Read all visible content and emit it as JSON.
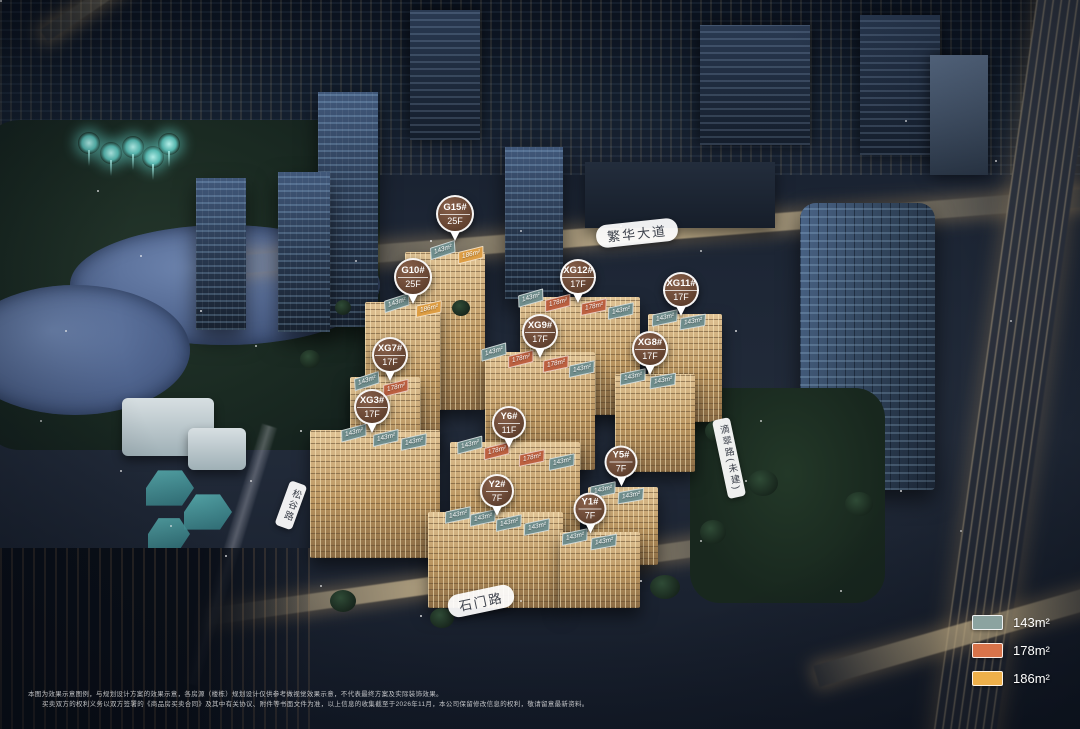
{
  "markers": [
    {
      "name": "G15#",
      "floors": "25F",
      "x": 455,
      "y": 218,
      "size": 38
    },
    {
      "name": "G10#",
      "floors": "25F",
      "x": 413,
      "y": 281,
      "size": 38
    },
    {
      "name": "XG12#",
      "floors": "17F",
      "x": 578,
      "y": 281,
      "size": 36
    },
    {
      "name": "XG11#",
      "floors": "17F",
      "x": 681,
      "y": 294,
      "size": 36
    },
    {
      "name": "XG9#",
      "floors": "17F",
      "x": 540,
      "y": 336,
      "size": 36
    },
    {
      "name": "XG8#",
      "floors": "17F",
      "x": 650,
      "y": 353,
      "size": 36
    },
    {
      "name": "XG7#",
      "floors": "17F",
      "x": 390,
      "y": 359,
      "size": 36
    },
    {
      "name": "XG3#",
      "floors": "17F",
      "x": 372,
      "y": 411,
      "size": 36
    },
    {
      "name": "Y6#",
      "floors": "11F",
      "x": 509,
      "y": 427,
      "size": 34
    },
    {
      "name": "Y5#",
      "floors": "7F",
      "x": 621,
      "y": 466,
      "size": 33
    },
    {
      "name": "Y2#",
      "floors": "7F",
      "x": 497,
      "y": 495,
      "size": 34
    },
    {
      "name": "Y1#",
      "floors": "7F",
      "x": 590,
      "y": 513,
      "size": 33
    }
  ],
  "tag_colors": {
    "143": "#6f8d8c",
    "178": "#bc6040",
    "186": "#dd9d43"
  },
  "area_tags": [
    {
      "label": "143m²",
      "type": "143",
      "x": 443,
      "y": 250,
      "rot": -18
    },
    {
      "label": "186m²",
      "type": "186",
      "x": 471,
      "y": 255,
      "rot": -14
    },
    {
      "label": "143m²",
      "type": "143",
      "x": 397,
      "y": 303,
      "rot": -18
    },
    {
      "label": "186m²",
      "type": "186",
      "x": 429,
      "y": 309,
      "rot": -12
    },
    {
      "label": "143m²",
      "type": "143",
      "x": 531,
      "y": 298,
      "rot": -16
    },
    {
      "label": "178m²",
      "type": "178",
      "x": 558,
      "y": 303,
      "rot": -14
    },
    {
      "label": "178m²",
      "type": "178",
      "x": 594,
      "y": 307,
      "rot": -12
    },
    {
      "label": "143m²",
      "type": "143",
      "x": 621,
      "y": 311,
      "rot": -12
    },
    {
      "label": "143m²",
      "type": "143",
      "x": 665,
      "y": 318,
      "rot": -12
    },
    {
      "label": "143m²",
      "type": "143",
      "x": 693,
      "y": 322,
      "rot": -10
    },
    {
      "label": "143m²",
      "type": "143",
      "x": 494,
      "y": 352,
      "rot": -16
    },
    {
      "label": "178m²",
      "type": "178",
      "x": 521,
      "y": 359,
      "rot": -14
    },
    {
      "label": "178m²",
      "type": "178",
      "x": 556,
      "y": 364,
      "rot": -12
    },
    {
      "label": "143m²",
      "type": "143",
      "x": 582,
      "y": 369,
      "rot": -12
    },
    {
      "label": "143m²",
      "type": "143",
      "x": 633,
      "y": 377,
      "rot": -12
    },
    {
      "label": "143m²",
      "type": "143",
      "x": 663,
      "y": 381,
      "rot": -10
    },
    {
      "label": "143m²",
      "type": "143",
      "x": 367,
      "y": 381,
      "rot": -18
    },
    {
      "label": "178m²",
      "type": "178",
      "x": 396,
      "y": 388,
      "rot": -14
    },
    {
      "label": "143m²",
      "type": "143",
      "x": 354,
      "y": 433,
      "rot": -15
    },
    {
      "label": "143m²",
      "type": "143",
      "x": 386,
      "y": 438,
      "rot": -13
    },
    {
      "label": "143m²",
      "type": "143",
      "x": 414,
      "y": 442,
      "rot": -12
    },
    {
      "label": "143m²",
      "type": "143",
      "x": 470,
      "y": 445,
      "rot": -15
    },
    {
      "label": "178m²",
      "type": "178",
      "x": 497,
      "y": 451,
      "rot": -14
    },
    {
      "label": "178m²",
      "type": "178",
      "x": 532,
      "y": 458,
      "rot": -12
    },
    {
      "label": "143m²",
      "type": "143",
      "x": 562,
      "y": 462,
      "rot": -12
    },
    {
      "label": "143m²",
      "type": "143",
      "x": 603,
      "y": 490,
      "rot": -12
    },
    {
      "label": "143m²",
      "type": "143",
      "x": 631,
      "y": 496,
      "rot": -10
    },
    {
      "label": "143m²",
      "type": "143",
      "x": 458,
      "y": 515,
      "rot": -12
    },
    {
      "label": "143m²",
      "type": "143",
      "x": 483,
      "y": 518,
      "rot": -12
    },
    {
      "label": "143m²",
      "type": "143",
      "x": 509,
      "y": 523,
      "rot": -12
    },
    {
      "label": "143m²",
      "type": "143",
      "x": 537,
      "y": 527,
      "rot": -12
    },
    {
      "label": "143m²",
      "type": "143",
      "x": 575,
      "y": 537,
      "rot": -12
    },
    {
      "label": "143m²",
      "type": "143",
      "x": 604,
      "y": 542,
      "rot": -10
    }
  ],
  "roads": [
    {
      "label": "繁华大道",
      "x": 637,
      "y": 233,
      "rot": -6,
      "style": "pill"
    },
    {
      "label": "石门路",
      "x": 481,
      "y": 601,
      "rot": -12,
      "style": "pill"
    },
    {
      "label": "滴翠路(未建)",
      "x": 729,
      "y": 458,
      "rot": -12,
      "style": "vertical"
    },
    {
      "label": "松谷路",
      "x": 291,
      "y": 505,
      "rot": 20,
      "style": "vertical"
    }
  ],
  "legend": {
    "items": [
      {
        "label": "143m²",
        "color": "#8ba3a0"
      },
      {
        "label": "178m²",
        "color": "#d8734a"
      },
      {
        "label": "186m²",
        "color": "#eeb04a"
      }
    ]
  },
  "disclaimer": {
    "lines": [
      "本图为效果示意图例，与规划设计方案的效果示意，各房源（楼栋）规划设计仅供参考做视觉效果示意，不代表最终方案及实际装饰效果。",
      "买卖双方的权利义务以双方签署的《商品房买卖合同》及其中有关协议、附件等书面文件为准，以上信息的收集截至于2026年11月，本公司保留修改信息的权利，敬请留意最新资料。"
    ]
  }
}
